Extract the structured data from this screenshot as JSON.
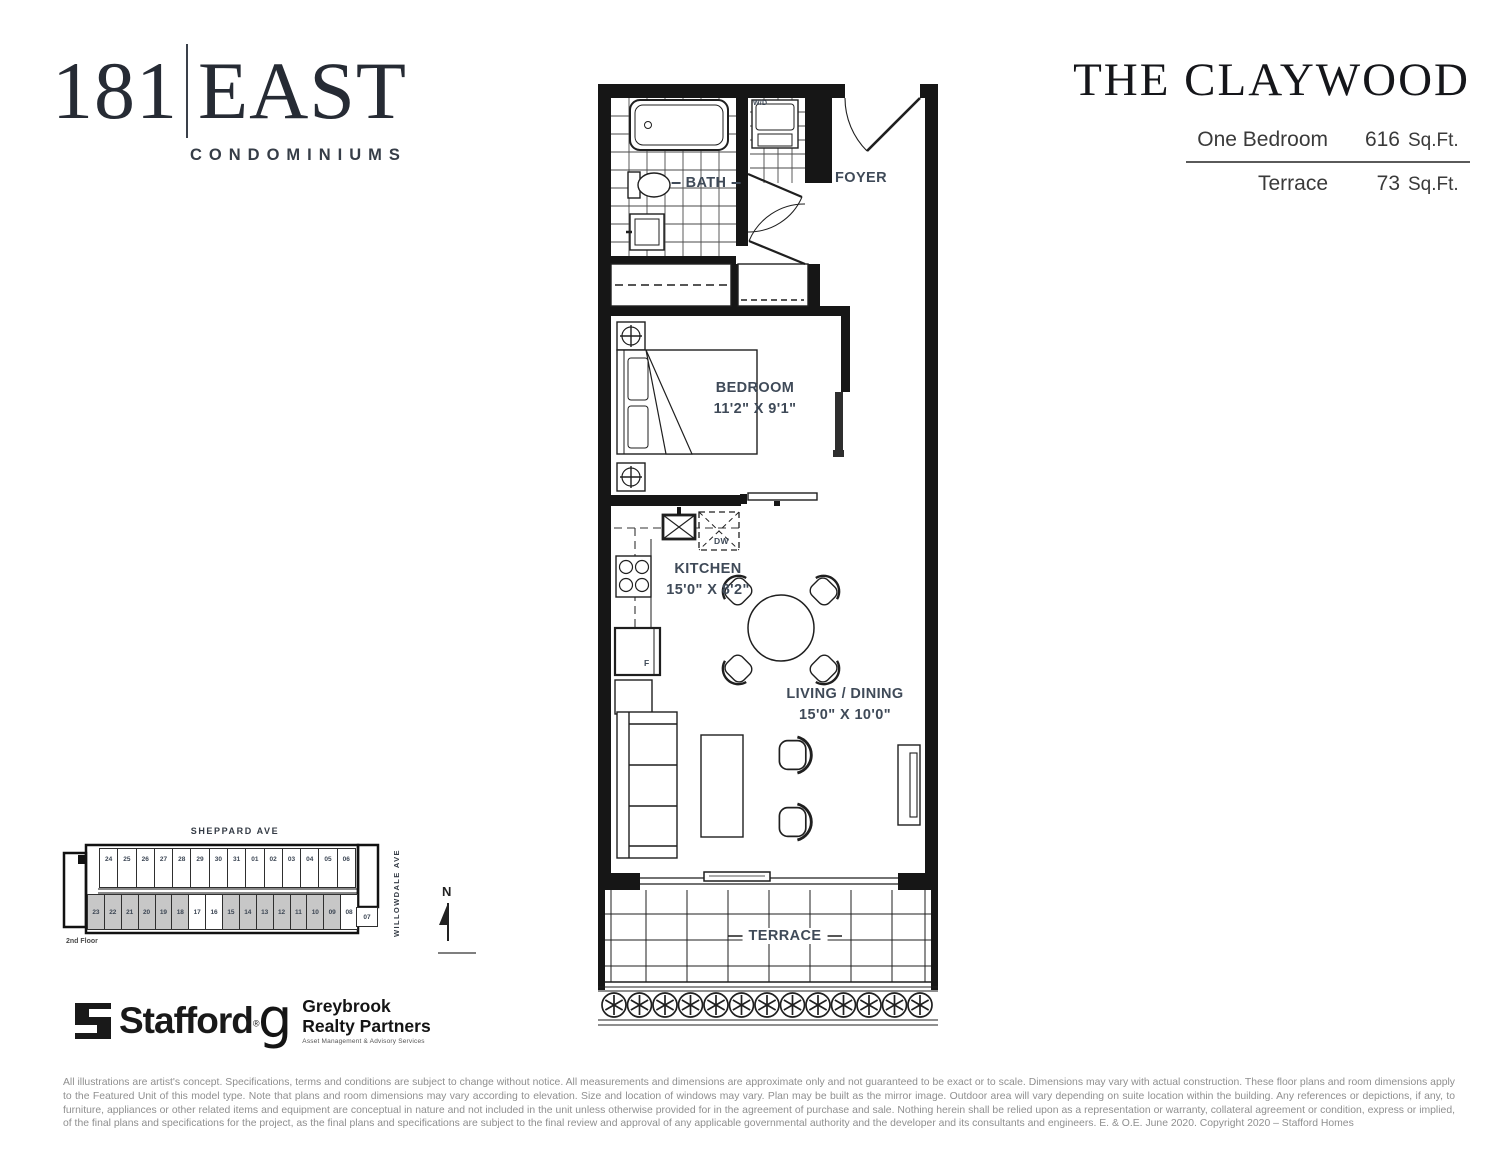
{
  "brand": {
    "number": "181",
    "name": "EAST",
    "sub": "CONDOMINIUMS"
  },
  "header": {
    "plan_name": "THE CLAYWOOD",
    "rows": [
      {
        "label": "One Bedroom",
        "value": "616",
        "unit": "Sq.Ft."
      },
      {
        "label": "Terrace",
        "value": "73",
        "unit": "Sq.Ft."
      }
    ]
  },
  "plan": {
    "labels": {
      "bath": "BATH",
      "wd": "W/D",
      "foyer": "FOYER",
      "bedroom": "BEDROOM",
      "bedroom_dims": "11'2\" X 9'1\"",
      "dw": "DW",
      "kitchen": "KITCHEN",
      "kitchen_dims": "15'0\" X 8'2\"",
      "fridge": "F",
      "living": "LIVING / DINING",
      "living_dims": "15'0\" X 10'0\"",
      "terrace": "TERRACE"
    }
  },
  "keyplan": {
    "street_top": "SHEPPARD AVE",
    "street_right": "WILLOWDALE AVE",
    "floor": "2nd Floor",
    "north": "N",
    "top_row": [
      "24",
      "25",
      "26",
      "27",
      "28",
      "29",
      "30",
      "31",
      "01",
      "02",
      "03",
      "04",
      "05",
      "06"
    ],
    "corner_unit": "07",
    "bottom_row": [
      "23",
      "22",
      "21",
      "20",
      "19",
      "18",
      "17",
      "16",
      "15",
      "14",
      "13",
      "12",
      "11",
      "10",
      "09",
      "08"
    ],
    "highlighted_units": [
      "17",
      "16",
      "08"
    ]
  },
  "logos": {
    "stafford": "Stafford",
    "stafford_reg": "®",
    "greybrook_g": "g",
    "greybrook_line1": "Greybrook",
    "greybrook_line2": "Realty Partners",
    "greybrook_tagline": "Asset Management & Advisory Services"
  },
  "disclaimer": "All illustrations are artist's concept. Specifications, terms and conditions are subject to change without notice. All measurements and dimensions are approximate only and not guaranteed to be exact or to scale. Dimensions may vary with actual construction. These floor plans and room dimensions apply to the Featured Unit of this model type. Note that plans and room dimensions may vary according to elevation. Size and location of windows may vary. Plan may be built as the mirror image. Outdoor area will vary depending on suite location within the building. Any references or depictions, if any, to furniture, appliances or other related items and equipment are conceptual in nature and not included in the unit unless otherwise provided for in the agreement of purchase and sale. Nothing herein shall be relied upon as a representation or warranty, collateral agreement or condition, express or implied, of the final plans and specifications for the project, as the final plans and specifications are subject to the final review and approval of any applicable governmental authority and the developer and its consultants and engineers. E. & O.E. June 2020. Copyright 2020 – Stafford Homes",
  "colors": {
    "label_accent": "#3f4a58",
    "wall": "#161616",
    "shaded_unit": "#c7c7c7"
  }
}
